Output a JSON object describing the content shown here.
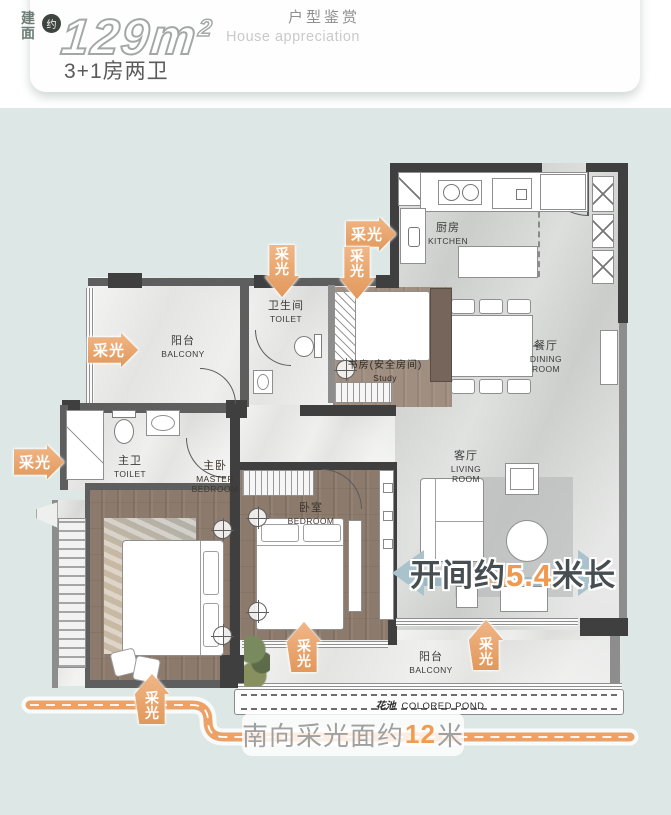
{
  "header": {
    "area_prefix_char1": "建",
    "area_prefix_char2": "面",
    "approx": "约",
    "area_value": "129",
    "area_unit": "m",
    "area_sup": "2",
    "layout_text": "3+1房两卫",
    "title_cn": "户型鉴赏",
    "title_en": "House appreciation"
  },
  "floorplan": {
    "rooms": {
      "balcony_top": {
        "cn": "阳台",
        "en": "BALCONY"
      },
      "toilet_shared": {
        "cn": "卫生间",
        "en": "TOILET"
      },
      "study": {
        "cn": "书房(安全房间)",
        "en": "Study"
      },
      "kitchen": {
        "cn": "厨房",
        "en": "KITCHEN"
      },
      "dining": {
        "cn": "餐厅",
        "en": "DINING ROOM"
      },
      "living": {
        "cn": "客厅",
        "en": "LIVING ROOM"
      },
      "master_bath": {
        "cn": "主卫",
        "en": "TOILET"
      },
      "master_bedroom": {
        "cn": "主卧",
        "en": "MASTER BEDROOM"
      },
      "bedroom": {
        "cn": "卧室",
        "en": "BEDROOM"
      },
      "balcony_bottom": {
        "cn": "阳台",
        "en": "BALCONY"
      },
      "pond": {
        "cn": "花池",
        "en": "COLORED POND"
      }
    },
    "light_label": "采光",
    "light_char_top": "采",
    "light_char_bottom": "光",
    "width_annotation": {
      "prefix": "开间约",
      "value": "5.4",
      "suffix": "米长"
    },
    "south_annotation": {
      "prefix": "南向采光面约",
      "value": "12",
      "suffix": "米"
    }
  },
  "colors": {
    "background": "#DDE8E6",
    "accent_orange": "#EB9E5E",
    "arrow_blue_gray": "#A9C2CC",
    "wall_dark": "#3F3F3F",
    "dim_value_orange": "#F0994F"
  }
}
